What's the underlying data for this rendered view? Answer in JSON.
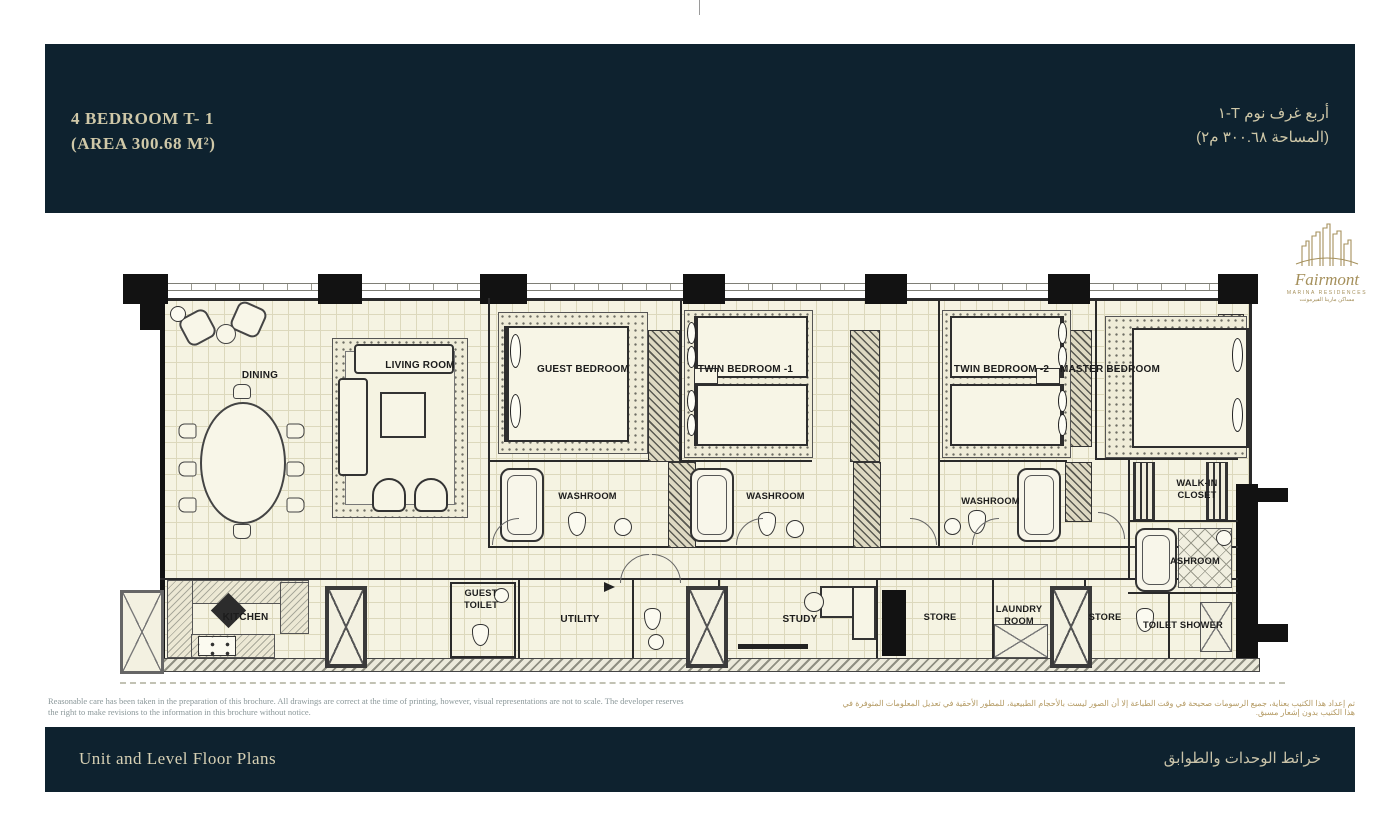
{
  "header": {
    "title_line1": "4 BEDROOM T- 1",
    "title_line2": "(AREA 300.68 M²)",
    "title_ar_line1": "أربع غرف نوم T-١",
    "title_ar_line2": "(المساحة ٣٠٠.٦٨ م٢)"
  },
  "logo": {
    "name": "Fairmont",
    "subtitle": "MARINA RESIDENCES",
    "subtitle_ar": "مساكن مارينا الفيرمونت"
  },
  "plan": {
    "rooms": {
      "dining": "DINING",
      "living_room": "LIVING ROOM",
      "guest_bedroom": "GUEST BEDROOM",
      "twin_bedroom_1": "TWIN BEDROOM -1",
      "twin_bedroom_2": "TWIN BEDROOM -2",
      "master_bedroom": "MASTER BEDROOM",
      "washroom_1": "WASHROOM",
      "washroom_2": "WASHROOM",
      "washroom_3": "WASHROOM",
      "walk_in_closet": "WALK-IN CLOSET",
      "master_washroom": "ASHROOM",
      "toilet_shower": "TOILET SHOWER",
      "kitchen": "KITCHEN",
      "guest_toilet": "GUEST TOILET",
      "utility": "UTILITY",
      "study": "STUDY",
      "store_1": "STORE",
      "laundry_room": "LAUNDRY ROOM",
      "store_2": "STORE"
    }
  },
  "disclaimer": {
    "en": "Reasonable care has been taken in the preparation of this brochure. All drawings are correct at the time of printing, however, visual representations are not to scale. The developer reserves the right to make revisions to the information in this brochure without notice.",
    "ar": "تم إعداد هذا الكتيب بعناية، جميع الرسومات صحيحة في وقت الطباعة إلا أن الصور ليست بالأحجام الطبيعية، للمطور الأحقية في تعديل المعلومات المتوفرة في هذا الكتيب بدون إشعار مسبق."
  },
  "footer": {
    "title_en": "Unit and Level Floor Plans",
    "title_ar": "خرائط الوحدات والطوابق"
  },
  "colors": {
    "navy": "#0e222f",
    "cream_text": "#cfc8a8",
    "gold": "#a5905c",
    "floor": "#f5f3e2"
  }
}
